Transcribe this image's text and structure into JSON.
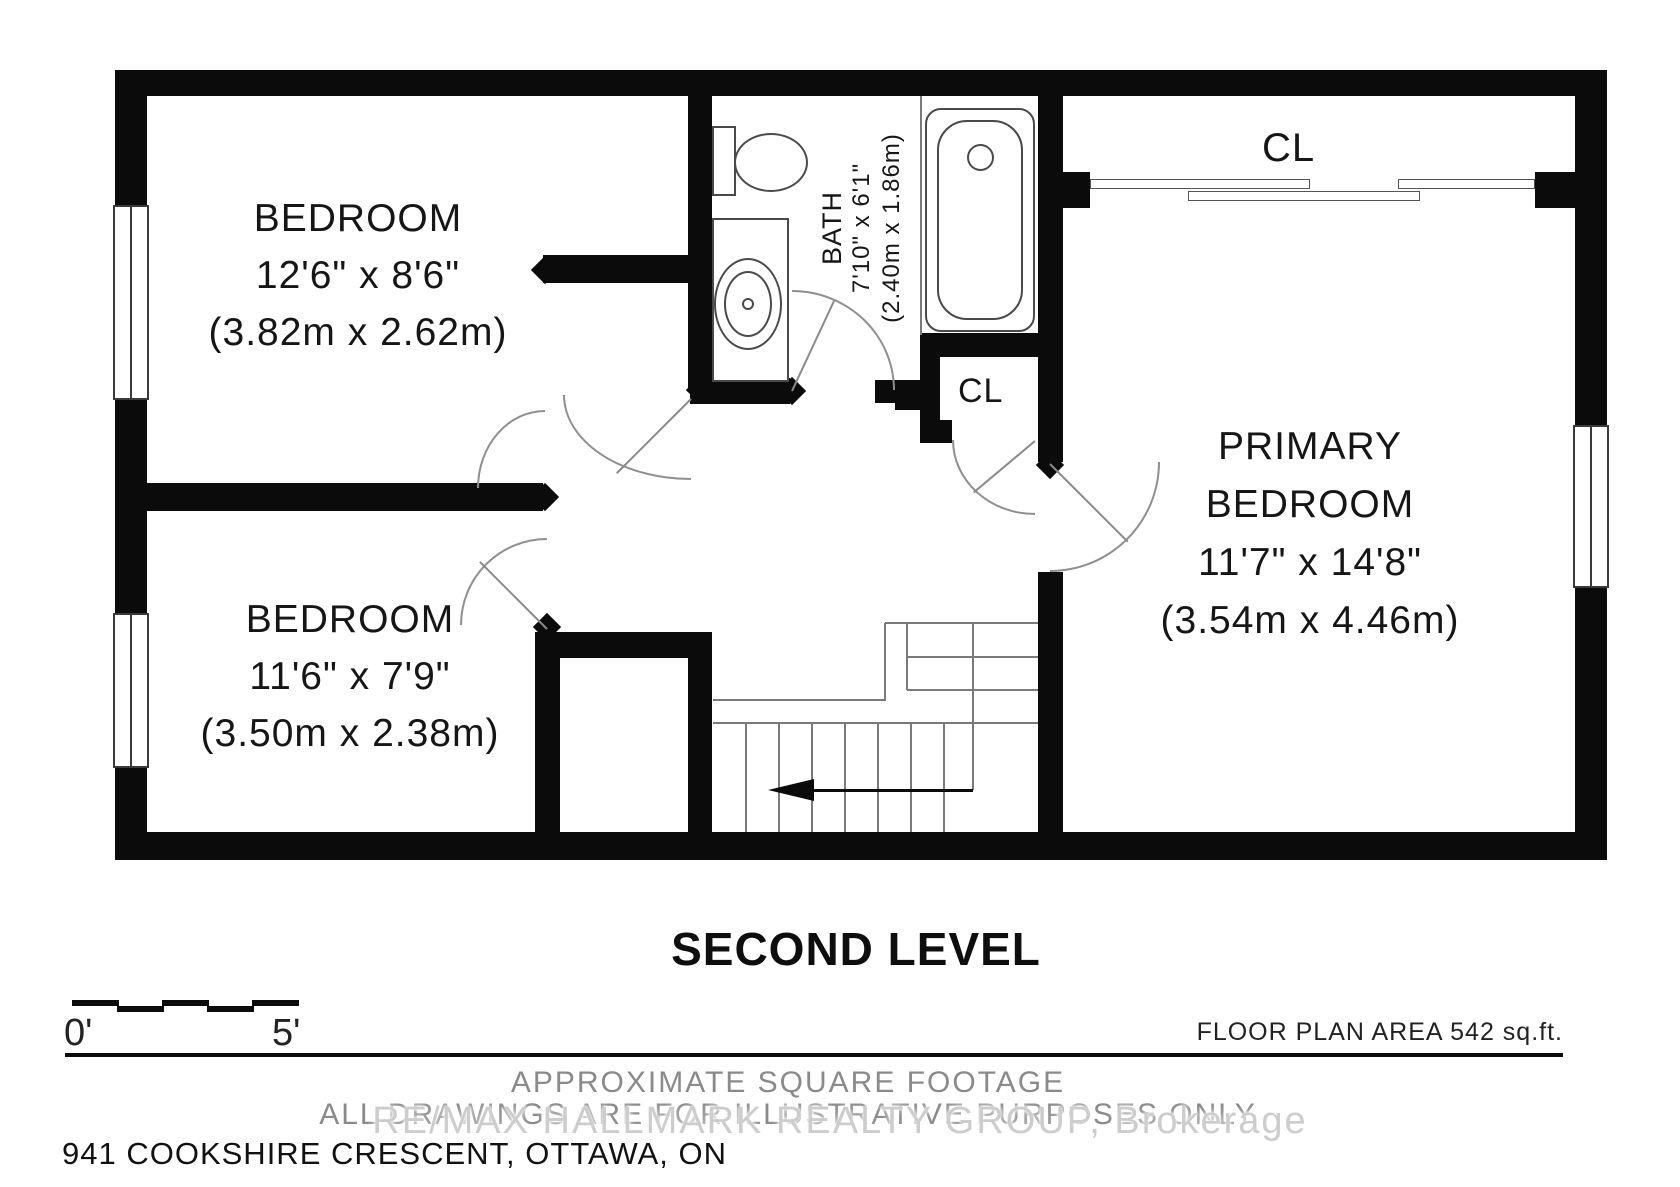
{
  "plan": {
    "title": "SECOND LEVEL",
    "rooms": {
      "bedroom_top": {
        "name": "BEDROOM",
        "imperial": "12'6\" x 8'6\"",
        "metric": "(3.82m x 2.62m)"
      },
      "bedroom_bottom": {
        "name": "BEDROOM",
        "imperial": "11'6\" x 7'9\"",
        "metric": "(3.50m x 2.38m)"
      },
      "primary_bedroom": {
        "name_line1": "PRIMARY",
        "name_line2": "BEDROOM",
        "imperial": "11'7\" x 14'8\"",
        "metric": "(3.54m x 4.46m)"
      },
      "bath": {
        "name": "BATH",
        "imperial": "7'10\" x 6'1\"",
        "metric": "(2.40m x 1.86m)"
      },
      "closet_top": {
        "name": "CL"
      },
      "closet_hall": {
        "name": "CL"
      }
    }
  },
  "scale_bar": {
    "start_label": "0'",
    "end_label": "5'"
  },
  "footer": {
    "area_note": "FLOOR PLAN AREA 542 sq.ft.",
    "disclaimer_line1": "APPROXIMATE SQUARE FOOTAGE",
    "disclaimer_line2": "ALL DRAWINGS ARE FOR ILLUSTRATIVE PURPOSES ONLY",
    "watermark": "RE/MAX HALLMARK REALTY GROUP, Brokerage",
    "address": "941 COOKSHIRE CRESCENT, OTTAWA, ON"
  },
  "colors": {
    "wall": "#0b0b0b",
    "line": "#7a7a7a",
    "text": "#161616",
    "muted": "#8a8a8a",
    "watermark": "#cdcdcd"
  }
}
